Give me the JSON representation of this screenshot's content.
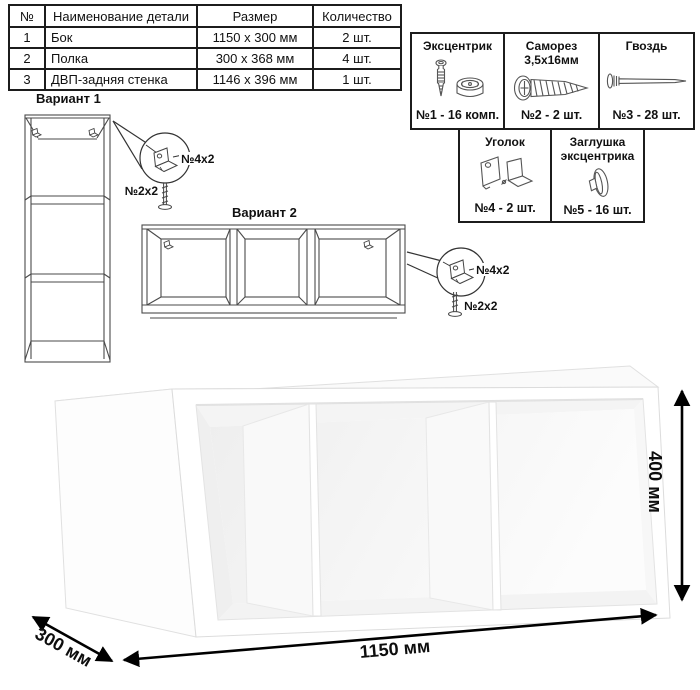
{
  "parts_table": {
    "headers": [
      "№",
      "Наименование детали",
      "Размер",
      "Количество"
    ],
    "rows": [
      {
        "num": "1",
        "name": "Бок",
        "size": "1150 x 300 мм",
        "qty": "2 шт."
      },
      {
        "num": "2",
        "name": "Полка",
        "size": "300 x 368 мм",
        "qty": "4 шт."
      },
      {
        "num": "3",
        "name": "ДВП-задняя стенка",
        "size": "1146 x 396 мм",
        "qty": "1 шт."
      }
    ]
  },
  "hardware": {
    "items": [
      {
        "title": "Эксцентрик",
        "title2": "",
        "count": "№1 - 16 комп.",
        "icon": "cam-and-dowel-icon"
      },
      {
        "title": "Саморез",
        "title2": "3,5х16мм",
        "count": "№2 - 2 шт.",
        "icon": "screw-icon"
      },
      {
        "title": "Гвоздь",
        "title2": "",
        "count": "№3 - 28 шт.",
        "icon": "nail-icon"
      },
      {
        "title": "Уголок",
        "title2": "",
        "count": "№4 - 2 шт.",
        "icon": "corner-bracket-icon"
      },
      {
        "title": "Заглушка",
        "title2": "эксцентрика",
        "count": "№5 - 16 шт.",
        "icon": "cam-cover-icon"
      }
    ]
  },
  "variant1": {
    "title": "Вариант 1",
    "bracket_label": "№4х2",
    "screw_label": "№2х2"
  },
  "variant2": {
    "title": "Вариант 2",
    "bracket_label": "№4х2",
    "screw_label": "№2х2"
  },
  "dimensions": {
    "width": "1150 мм",
    "height": "400 мм",
    "depth": "300 мм"
  }
}
